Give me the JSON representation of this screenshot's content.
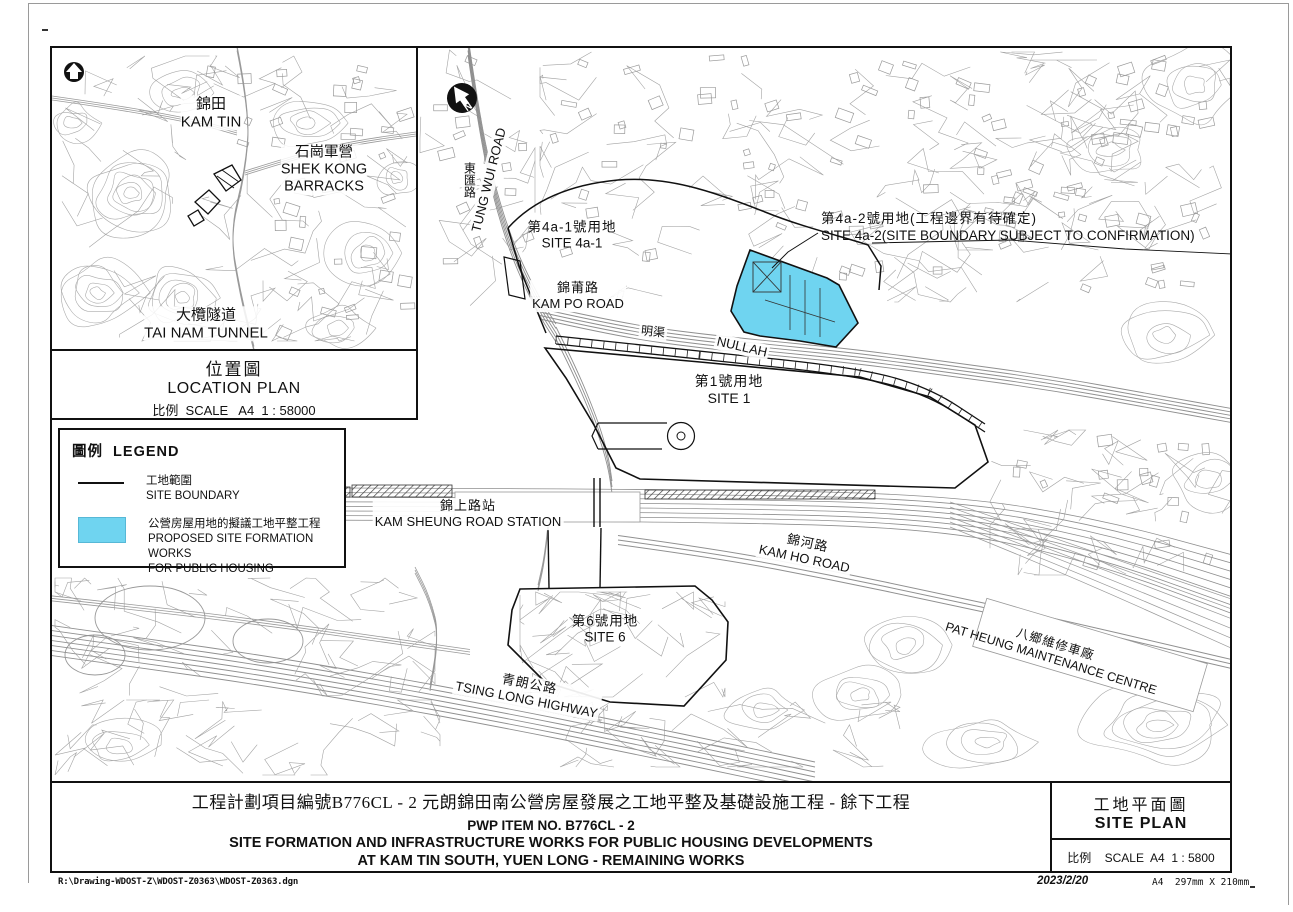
{
  "colors": {
    "site_fill_cyan": "#6fd4f0",
    "map_gray": "#9a9a9a",
    "boundary_black": "#111111"
  },
  "inset": {
    "labels": {
      "kam_tin_zh": "錦田",
      "kam_tin_en": "KAM TIN",
      "shek_kong_zh": "石崗軍營",
      "shek_kong_en1": "SHEK KONG",
      "shek_kong_en2": "BARRACKS",
      "tai_nam_zh": "大欖隧道",
      "tai_nam_en": "TAI NAM TUNNEL"
    },
    "caption": {
      "title_zh": "位置圖",
      "title_en": "LOCATION PLAN",
      "scale": "比例  SCALE   A4  1 : 58000"
    },
    "north_letter": "N"
  },
  "legend": {
    "title": "圖例  LEGEND",
    "items": [
      {
        "zh": "工地範圍",
        "en": "SITE BOUNDARY"
      },
      {
        "zh": "公營房屋用地的擬議工地平整工程",
        "en1": "PROPOSED SITE FORMATION WORKS",
        "en2": "FOR PUBLIC HOUSING"
      }
    ]
  },
  "map_labels": {
    "tung_wui_zh": "東匯路",
    "tung_wui_en": "TUNG WUI ROAD",
    "site4a1_zh": "第4a-1號用地",
    "site4a1_en": "SITE 4a-1",
    "site4a2_zh": "第4a-2號用地(工程邊界有待確定)",
    "site4a2_en": "SITE 4a-2(SITE BOUNDARY SUBJECT TO CONFIRMATION)",
    "kam_po_zh": "錦莆路",
    "kam_po_en": "KAM PO ROAD",
    "nullah_zh": "明渠",
    "nullah_en": "NULLAH",
    "site1_zh": "第1號用地",
    "site1_en": "SITE 1",
    "station_zh": "錦上路站",
    "station_en": "KAM SHEUNG ROAD STATION",
    "kam_ho_zh": "錦河路",
    "kam_ho_en": "KAM HO ROAD",
    "site6_zh": "第6號用地",
    "site6_en": "SITE 6",
    "tsing_long_zh": "青朗公路",
    "tsing_long_en": "TSING LONG HIGHWAY",
    "pat_heung_zh": "八鄉維修車廠",
    "pat_heung_en": "PAT HEUNG MAINTENANCE CENTRE",
    "north_letter": "N"
  },
  "title_block": {
    "line1_zh": "工程計劃項目編號B776CL - 2 元朗錦田南公營房屋發展之工地平整及基礎設施工程 - 餘下工程",
    "line2": "PWP ITEM NO. B776CL - 2",
    "line3": "SITE FORMATION AND INFRASTRUCTURE WORKS FOR PUBLIC HOUSING DEVELOPMENTS",
    "line4": "AT KAM TIN SOUTH, YUEN LONG - REMAINING WORKS",
    "plan_title_zh": "工地平面圖",
    "plan_title_en": "SITE PLAN",
    "plan_scale": "比例    SCALE  A4  1 : 5800"
  },
  "footer": {
    "file_path": "R:\\Drawing-WDOST-Z\\WDOST-Z0363\\WDOST-Z0363.dgn",
    "date": "2023/2/20",
    "paper": "A4  297mm X 210mm"
  }
}
